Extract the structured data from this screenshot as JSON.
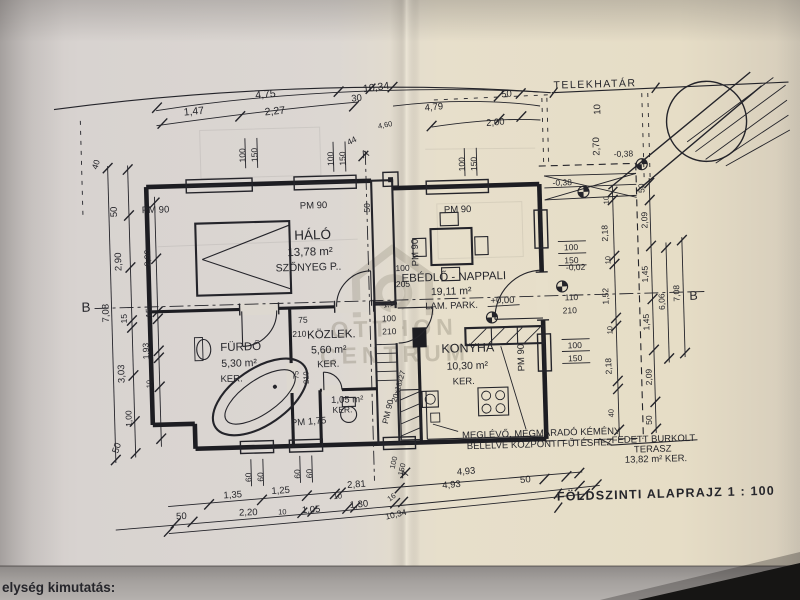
{
  "sheet": {
    "title": "FÖLDSZINTI ALAPRAJZ  1 : 100",
    "bottom_label": "elység kimutatás:"
  },
  "site": {
    "boundary": "TELEKHATÁR"
  },
  "watermark": {
    "line1": "OTTHON",
    "line2": "CENTRUM"
  },
  "markers": {
    "a": "A",
    "b": "B"
  },
  "levels": {
    "zero": "+0,00",
    "m02": "-0,02",
    "m38": "-0,38"
  },
  "windows": {
    "pm90": "PM 90",
    "pm175": "PM 1,75",
    "w100": "100",
    "w150": "150",
    "w60": "60",
    "w50": "50"
  },
  "doors": {
    "d75": "75",
    "d210": "210",
    "d110": "1,10",
    "d100": "100",
    "d205": "205",
    "dw110": "110"
  },
  "stairs": {
    "riser": "20x18x27"
  },
  "notes": {
    "chimney1": "MEGLÉVŐ, MEGMARADÓ KÉMÉNY",
    "chimney2": "BÉLELVE KÖZPONTI FŰTÉSHEZ"
  },
  "rooms": {
    "halo": {
      "name": "HÁLÓ",
      "area": "13,78 m²",
      "floor": "SZŐNYEG P.."
    },
    "ebedlo": {
      "name": "EBÉDLŐ - NAPPALI",
      "area": "19,11 m²",
      "floor": "LAM. PARK."
    },
    "furdo": {
      "name": "FÜRDŐ",
      "area": "5,30 m²",
      "floor": "KER."
    },
    "kozlek": {
      "name": "KÖZLEK.",
      "area": "5,60 m²",
      "floor": "KER."
    },
    "wc": {
      "area": "1,05 m²",
      "floor": "KER."
    },
    "konyha": {
      "name": "KONYHA",
      "area": "10,30 m²",
      "floor": "KER."
    },
    "terasz": {
      "name1": "FEDETT BURKOLT",
      "name2": "TERASZ",
      "area": "13,82 m² KER."
    }
  },
  "dims": {
    "top": {
      "overall": "10,34",
      "a": "4,75",
      "b": "30",
      "c": "1,47",
      "d": "2,27",
      "e": "4,79",
      "f": "50",
      "g": "2,00",
      "h": "44",
      "i": "4,60",
      "j": "10",
      "k": "2,70"
    },
    "left": {
      "a": "40",
      "b": "50",
      "c": "2,90",
      "overall": "7,08",
      "d": "15",
      "e": "3,03",
      "f": "1,00",
      "g": "50",
      "h": "2,90",
      "i": "15",
      "j": "1,93",
      "k": "10"
    },
    "right": {
      "a": "10",
      "b": "2,18",
      "c": "10",
      "d": "1,52",
      "e": "10",
      "f": "2,18",
      "g": "40",
      "h": "50",
      "i": "2,09",
      "j": "1,45",
      "k": "1,45",
      "l": "2,09",
      "m": "50",
      "n": "6,06",
      "overall": "7,08"
    },
    "bottom": {
      "a": "1,35",
      "b": "1,25",
      "c": "2,81",
      "d": "10",
      "e": "4,93",
      "f": "4,93",
      "g": "50",
      "h": "50",
      "i": "2,20",
      "j": "10",
      "k": "1,05",
      "l": "1,30",
      "m": "16",
      "overall": "10,34",
      "n": "100",
      "o": "150"
    }
  },
  "colors": {
    "ink": "#24242a",
    "paper_left": "#d8d3d0",
    "paper_right": "#e8dfca",
    "band": "#a09c99",
    "watermark": "#867f6f"
  }
}
